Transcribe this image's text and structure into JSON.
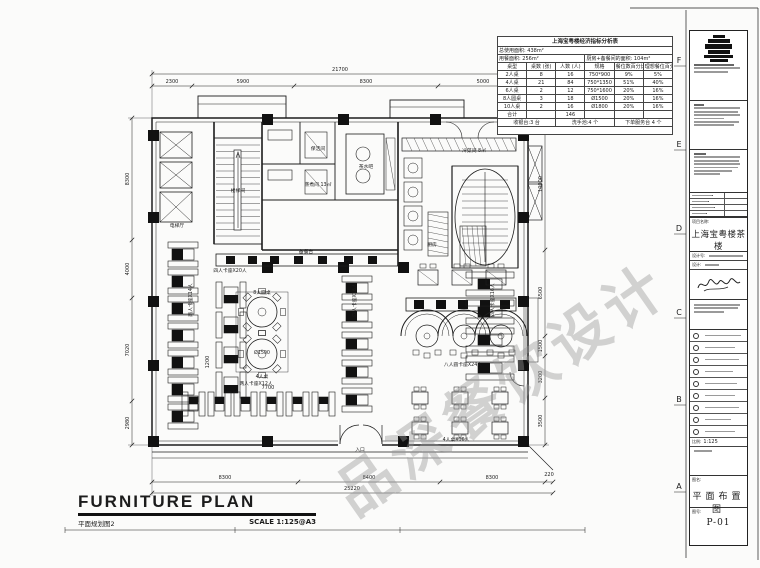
{
  "colors": {
    "ink": "#1c1c1c",
    "watermark": "#969696",
    "paper": "#fbfbfa"
  },
  "watermark": {
    "text": "品深餐饮设计"
  },
  "grid_letters": [
    "F",
    "E",
    "D",
    "C",
    "B",
    "A"
  ],
  "footer_title": {
    "en": "FURNITURE PLAN",
    "cn": "平面规划图2",
    "scale": "SCALE  1:125@A3"
  },
  "indicator_table": {
    "title": "上海宝粤楼经济指标分析表",
    "total_area": "总使用面积: 438m²",
    "dining_area": "用餐面积: 256m²",
    "kitchen_area": "厨房+备餐间的面积: 104m²",
    "headers": [
      "桌型",
      "桌数 (张)",
      "人数 (人)",
      "规格",
      "餐位数百分比",
      "理想餐位百分比"
    ],
    "rows": [
      [
        "2人桌",
        "8",
        "16",
        "750*900",
        "9%",
        "5%"
      ],
      [
        "4人桌",
        "21",
        "84",
        "750*1350",
        "51%",
        "40%"
      ],
      [
        "6人桌",
        "2",
        "12",
        "750*1600",
        "20%",
        "16%"
      ],
      [
        "8人圆桌",
        "3",
        "18",
        "Ø1500",
        "20%",
        "16%"
      ],
      [
        "10人桌",
        "2",
        "16",
        "Ø1800",
        "20%",
        "16%"
      ],
      [
        "合计",
        "",
        "146",
        "",
        "",
        ""
      ]
    ],
    "footer": [
      "收银台:3 台",
      "洗手池:4 个",
      "下单服务台 4 个"
    ]
  },
  "title_block": {
    "project_label": "项目名称:",
    "project_name": "上海宝粤楼茶楼",
    "design_no_label": "设计号:",
    "design_label": "设计:",
    "scale_label": "比例:",
    "scale_value": "1:125",
    "drawing_name_label": "图名:",
    "drawing_name": "平面布置图",
    "drawing_no_label": "图号:",
    "drawing_no": "P-01"
  },
  "dim_labels": [
    {
      "t": "21700",
      "x": 340,
      "y": 71,
      "r": 0
    },
    {
      "t": "2300",
      "x": 172,
      "y": 83,
      "r": 0
    },
    {
      "t": "5900",
      "x": 243,
      "y": 83,
      "r": 0
    },
    {
      "t": "8300",
      "x": 366,
      "y": 83,
      "r": 0
    },
    {
      "t": "5000",
      "x": 483,
      "y": 83,
      "r": 0
    },
    {
      "t": "8300",
      "x": 129,
      "y": 179,
      "r": -90
    },
    {
      "t": "4000",
      "x": 129,
      "y": 269,
      "r": -90
    },
    {
      "t": "7020",
      "x": 129,
      "y": 350,
      "r": -90
    },
    {
      "t": "2980",
      "x": 129,
      "y": 423,
      "r": -90
    },
    {
      "t": "10000",
      "x": 542,
      "y": 184,
      "r": -90
    },
    {
      "t": "6500",
      "x": 542,
      "y": 293,
      "r": -90
    },
    {
      "t": "1500",
      "x": 542,
      "y": 346,
      "r": -90
    },
    {
      "t": "3200",
      "x": 542,
      "y": 377,
      "r": -90
    },
    {
      "t": "3500",
      "x": 542,
      "y": 421,
      "r": -90
    },
    {
      "t": "8300",
      "x": 225,
      "y": 479,
      "r": 0
    },
    {
      "t": "8400",
      "x": 369,
      "y": 479,
      "r": 0
    },
    {
      "t": "8300",
      "x": 492,
      "y": 479,
      "r": 0
    },
    {
      "t": "220",
      "x": 549,
      "y": 476,
      "r": 0
    },
    {
      "t": "25220",
      "x": 352,
      "y": 490,
      "r": 0
    },
    {
      "t": "7700",
      "x": 268,
      "y": 389,
      "r": 0
    },
    {
      "t": "1200",
      "x": 209,
      "y": 362,
      "r": -90
    }
  ],
  "plan_labels": [
    {
      "t": "楼梯间",
      "x": 238,
      "y": 192,
      "r": 0
    },
    {
      "t": "电梯厅",
      "x": 177,
      "y": 227,
      "r": 0
    },
    {
      "t": "保洁间",
      "x": 318,
      "y": 150,
      "r": 0
    },
    {
      "t": "蒸煮间 13㎡",
      "x": 318,
      "y": 186,
      "r": 0
    },
    {
      "t": "茶水吧",
      "x": 366,
      "y": 168,
      "r": 0
    },
    {
      "t": "冷菜间 8㎡",
      "x": 474,
      "y": 152,
      "r": 0
    },
    {
      "t": "厨房",
      "x": 432,
      "y": 246,
      "r": 0
    },
    {
      "t": "备餐台",
      "x": 306,
      "y": 253,
      "r": 0
    },
    {
      "t": "两人卡座X14人",
      "x": 192,
      "y": 300,
      "r": -90
    },
    {
      "t": "四人卡座X20人",
      "x": 230,
      "y": 272,
      "r": 0
    },
    {
      "t": "8人圆桌",
      "x": 262,
      "y": 294,
      "r": 0
    },
    {
      "t": "Ø1500",
      "x": 262,
      "y": 354,
      "r": 0
    },
    {
      "t": "4人桌",
      "x": 262,
      "y": 378,
      "r": 0
    },
    {
      "t": "四人卡座X16人",
      "x": 356,
      "y": 300,
      "r": -90
    },
    {
      "t": "四人卡座X16人",
      "x": 494,
      "y": 300,
      "r": -90
    },
    {
      "t": "八人圆卡座X24人",
      "x": 463,
      "y": 366,
      "r": 0
    },
    {
      "t": "4人桌X16人",
      "x": 456,
      "y": 441,
      "r": 0
    },
    {
      "t": "两人卡座X12人",
      "x": 256,
      "y": 385,
      "r": 0
    },
    {
      "t": "入口",
      "x": 360,
      "y": 451,
      "r": 0
    }
  ]
}
